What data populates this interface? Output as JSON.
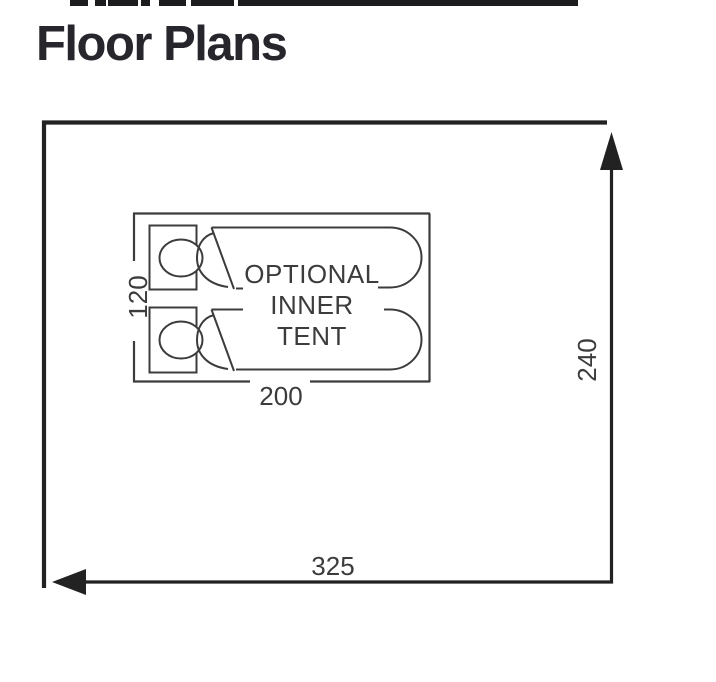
{
  "title": {
    "text": "Floor Plans"
  },
  "colors": {
    "background": "#ffffff",
    "title_text": "#26262c",
    "diagram_lines": "#3c3c3c",
    "outer_outline": "#222222",
    "top_bar": "#1c1c1e"
  },
  "floor_plan": {
    "tent": {
      "width": "325",
      "height": "240"
    },
    "inner_tent": {
      "label": {
        "line1": "OPTIONAL",
        "line2": "INNER",
        "line3": "TENT"
      },
      "width": "200",
      "height": "120"
    }
  }
}
